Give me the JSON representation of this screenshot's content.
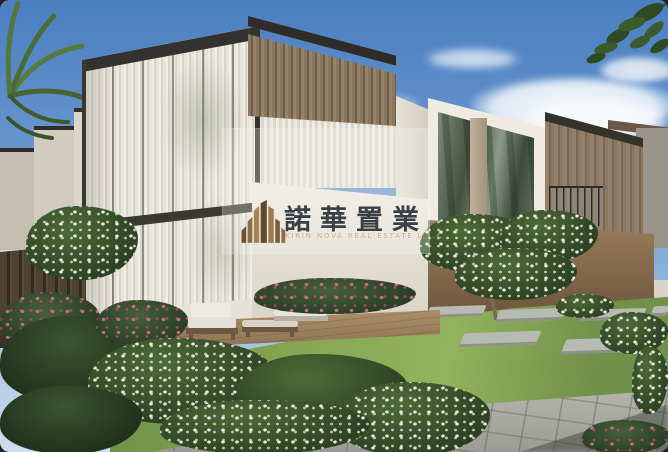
{
  "scene": {
    "caption": "Architectural rendering of modern two-storey townhouses with floor-to-ceiling glazed corner, sheer white curtains, timber louvre screens and wood cladding; flowering white and pink garden beds, green lawn with stepping stones, timber patio with outdoor lounge furniture, paved walkway, palm fronds and tree foliage against a blue sky with clouds",
    "elements": [
      "sky",
      "clouds",
      "palm-fronds",
      "tree-branch",
      "stepped-parapet-walls",
      "glass-facade-with-curtains",
      "timber-louvre-canopy",
      "terrace",
      "middle-townhouse",
      "reflective-glass",
      "timber-clad-townhouse",
      "balcony-railing",
      "distant-building",
      "garden-wall",
      "flowering-tree",
      "lawn",
      "stepping-stones",
      "patio-deck",
      "lounge-chair",
      "coffee-table",
      "outdoor-sofa",
      "garden-fence",
      "flower-beds",
      "paved-walkway",
      "watermark"
    ]
  },
  "watermark": {
    "logo_name": "kirin-nova-mountain-logo",
    "title_cn": "諾華置業",
    "subtitle_en": "KIRIN NOVA REAL-ESTATE L.L.C",
    "panel_color": "rgba(242,242,240,0.30)",
    "title_color": "#3b4046",
    "subtitle_color": "#c9a873",
    "logo_colors": {
      "dark": "#5e4a2c",
      "mid": "#8a6d43",
      "light": "#a5854f"
    }
  },
  "palette": {
    "sky-top": "#4b7fc0",
    "sky-low": "#cfdeee",
    "cloud": "#f7fafc",
    "wall-light": "#efebe2",
    "curtain-light": "#f1eee7",
    "curtain-dark": "#d9d4ca",
    "wood": "#8a775f",
    "wood-dark": "#6e5d49",
    "glass-dark": "#46523f",
    "lawn-light": "#86a854",
    "lawn-dark": "#71904a",
    "bush": "#2c4123",
    "bush-dark": "#1f301b",
    "fence": "#4e4233",
    "patio": "#ad9068",
    "paver": "#b6b6ae",
    "cushion": "#edeae2",
    "ink": "#3b4046",
    "gold": "#c9a873"
  }
}
